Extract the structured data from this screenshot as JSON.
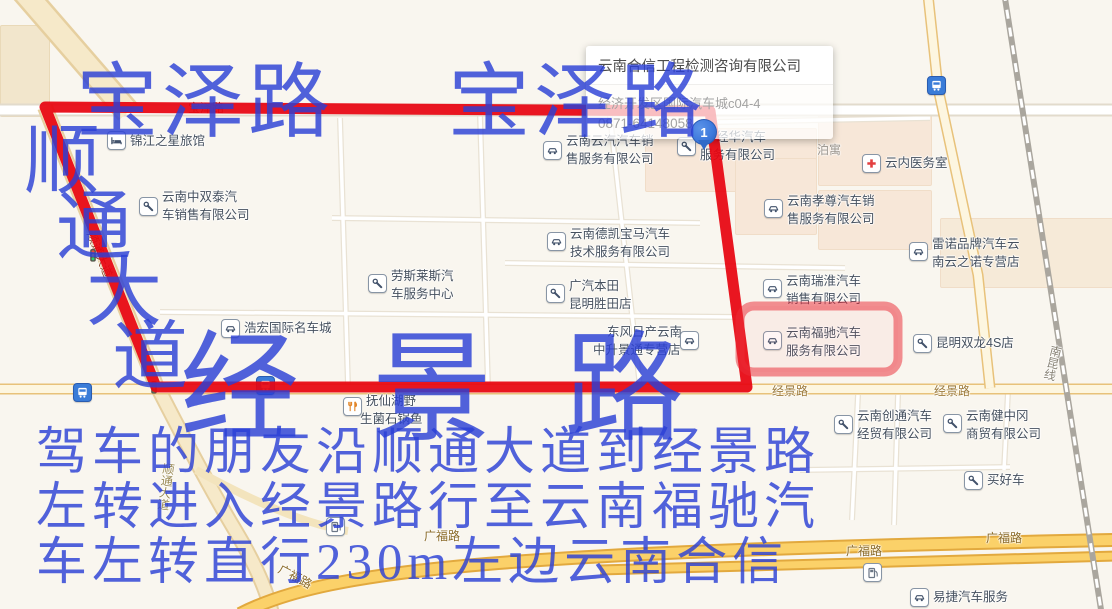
{
  "popup": {
    "title": "云南合信工程检测咨询有限公司",
    "address": "经济开发区国际汽车城c04-4",
    "phone": "0871-64148058"
  },
  "marker": {
    "label": "1"
  },
  "annotations": {
    "baoze_left": "宝泽路",
    "baoze_right": "宝泽路",
    "shuntong_chars": [
      {
        "t": "顺",
        "x": 24,
        "y": 124
      },
      {
        "t": "通",
        "x": 56,
        "y": 190
      },
      {
        "t": "大",
        "x": 86,
        "y": 256
      },
      {
        "t": "道",
        "x": 112,
        "y": 320
      }
    ],
    "jingjing_big": "经景路",
    "directions_lines": [
      {
        "t": "驾车的朋友沿顺通大道到经景路",
        "y": 428
      },
      {
        "t": "左转进入经景路行至云南福驰汽",
        "y": 483
      },
      {
        "t": "车左转直行230m左边云南合信",
        "y": 538
      }
    ]
  },
  "map": {
    "road_labels": [
      {
        "t": "宝泽路",
        "x": 188,
        "y": 102,
        "color": "#7a2a1a"
      },
      {
        "t": "经景路",
        "x": 772,
        "y": 385,
        "color": "#9c7a3a"
      },
      {
        "t": "经景路",
        "x": 934,
        "y": 385,
        "color": "#9c7a3a"
      },
      {
        "t": "广福路",
        "x": 424,
        "y": 530,
        "color": "#8a6a28"
      },
      {
        "t": "广福路",
        "x": 846,
        "y": 545,
        "color": "#8a6a28"
      },
      {
        "t": "广福路",
        "x": 986,
        "y": 532,
        "color": "#8a6a28"
      },
      {
        "t": "广福路",
        "x": 282,
        "y": 563,
        "color": "#8a6a28",
        "rot": 28
      },
      {
        "t": "南昆线",
        "x": 1051,
        "y": 344,
        "color": "#8a8578",
        "vert": true,
        "rot": 14
      },
      {
        "t": "顺通大道",
        "x": 96,
        "y": 230,
        "color": "#8a4a2a",
        "rot": 68
      },
      {
        "t": "顺通大道",
        "x": 163,
        "y": 462,
        "color": "#9a8a55",
        "vert": true,
        "rot": 8
      },
      {
        "t": "泊寓",
        "x": 817,
        "y": 144,
        "color": "#9a948c"
      }
    ],
    "pois": [
      {
        "icon": "hotel",
        "ix": 116,
        "iy": 140,
        "lines": [
          {
            "t": "锦江之星旅馆",
            "x": 130,
            "y": 135
          }
        ]
      },
      {
        "icon": "wrench",
        "ix": 148,
        "iy": 206,
        "lines": [
          {
            "t": "云南中双泰汽",
            "x": 162,
            "y": 191
          },
          {
            "t": "车销售有限公司",
            "x": 162,
            "y": 209
          }
        ]
      },
      {
        "icon": "car",
        "ix": 552,
        "iy": 150,
        "lines": [
          {
            "t": "云南云汽汽车销",
            "x": 566,
            "y": 135
          },
          {
            "t": "售服务有限公司",
            "x": 566,
            "y": 153
          }
        ]
      },
      {
        "icon": "wrench",
        "ix": 686,
        "iy": 146,
        "lines": [
          {
            "t": "经华汽车",
            "x": 716,
            "y": 131
          },
          {
            "t": "服务有限公司",
            "x": 700,
            "y": 149
          }
        ]
      },
      {
        "icon": "car",
        "ix": 773,
        "iy": 208,
        "lines": [
          {
            "t": "云南孝尊汽车销",
            "x": 787,
            "y": 195
          },
          {
            "t": "售服务有限公司",
            "x": 787,
            "y": 213
          }
        ]
      },
      {
        "icon": "cross",
        "ix": 871,
        "iy": 163,
        "lines": [
          {
            "t": "云内医务室",
            "x": 885,
            "y": 157
          }
        ]
      },
      {
        "icon": "car",
        "ix": 918,
        "iy": 251,
        "lines": [
          {
            "t": "雷诺品牌汽车云",
            "x": 932,
            "y": 238
          },
          {
            "t": "南云之诺专营店",
            "x": 932,
            "y": 256
          }
        ]
      },
      {
        "icon": "car",
        "ix": 556,
        "iy": 241,
        "lines": [
          {
            "t": "云南德凯宝马汽车",
            "x": 570,
            "y": 228
          },
          {
            "t": "技术服务有限公司",
            "x": 570,
            "y": 246
          }
        ]
      },
      {
        "icon": "wrench",
        "ix": 377,
        "iy": 283,
        "lines": [
          {
            "t": "劳斯莱斯汽",
            "x": 391,
            "y": 270
          },
          {
            "t": "车服务中心",
            "x": 391,
            "y": 288
          }
        ]
      },
      {
        "icon": "wrench",
        "ix": 555,
        "iy": 293,
        "lines": [
          {
            "t": "广汽本田",
            "x": 569,
            "y": 280
          },
          {
            "t": "昆明胜田店",
            "x": 569,
            "y": 298
          }
        ]
      },
      {
        "icon": "car",
        "ix": 772,
        "iy": 288,
        "lines": [
          {
            "t": "云南瑞淮汽车",
            "x": 786,
            "y": 275
          },
          {
            "t": "销售有限公司",
            "x": 786,
            "y": 293
          }
        ]
      },
      {
        "icon": "car",
        "ix": 230,
        "iy": 328,
        "lines": [
          {
            "t": "浩宏国际名车城",
            "x": 244,
            "y": 322
          }
        ]
      },
      {
        "icon": "car",
        "ix": 772,
        "iy": 340,
        "lines": [
          {
            "t": "云南福驰汽车",
            "x": 786,
            "y": 327
          },
          {
            "t": "服务有限公司",
            "x": 786,
            "y": 345
          }
        ]
      },
      {
        "icon": "wrench",
        "ix": 922,
        "iy": 343,
        "lines": [
          {
            "t": "昆明双龙4S店",
            "x": 936,
            "y": 337
          }
        ]
      },
      {
        "icon": "car",
        "ix": 689,
        "iy": 340,
        "lines": [
          {
            "t": "东风日产云南",
            "x": 607,
            "y": 326
          },
          {
            "t": "中升景通专营店",
            "x": 593,
            "y": 344
          }
        ]
      },
      {
        "icon": "food",
        "ix": 352,
        "iy": 406,
        "lines": [
          {
            "t": "抚仙湖野",
            "x": 366,
            "y": 395
          },
          {
            "t": "生菌石锅鱼",
            "x": 360,
            "y": 413
          }
        ]
      },
      {
        "icon": "wrench",
        "ix": 843,
        "iy": 424,
        "lines": [
          {
            "t": "云南创通汽车",
            "x": 857,
            "y": 410
          },
          {
            "t": "经贸有限公司",
            "x": 857,
            "y": 428
          }
        ]
      },
      {
        "icon": "wrench",
        "ix": 952,
        "iy": 423,
        "lines": [
          {
            "t": "云南健中冈",
            "x": 966,
            "y": 410
          },
          {
            "t": "商贸有限公司",
            "x": 966,
            "y": 428
          }
        ]
      },
      {
        "icon": "wrench",
        "ix": 973,
        "iy": 480,
        "lines": [
          {
            "t": "买好车",
            "x": 987,
            "y": 474
          }
        ]
      },
      {
        "icon": "car",
        "ix": 919,
        "iy": 597,
        "lines": [
          {
            "t": "易捷汽车服务",
            "x": 933,
            "y": 591
          }
        ]
      },
      {
        "icon": "bus",
        "ix": 936,
        "iy": 85,
        "lines": []
      },
      {
        "icon": "bus",
        "ix": 82,
        "iy": 392,
        "lines": []
      },
      {
        "icon": "bus",
        "ix": 265,
        "iy": 385,
        "lines": []
      },
      {
        "icon": "gas",
        "ix": 872,
        "iy": 572,
        "lines": []
      },
      {
        "icon": "gas",
        "ix": 335,
        "iy": 526,
        "lines": []
      },
      {
        "icon": "signal",
        "ix": 158,
        "iy": 388,
        "lines": []
      },
      {
        "icon": "signal",
        "ix": 97,
        "iy": 256,
        "lines": []
      }
    ]
  },
  "colors": {
    "route_red": "#e8060f",
    "annotation_blue": "#2b3fd5",
    "highlight_box": "#e82d37",
    "pin_blue": "#3c78dc"
  }
}
